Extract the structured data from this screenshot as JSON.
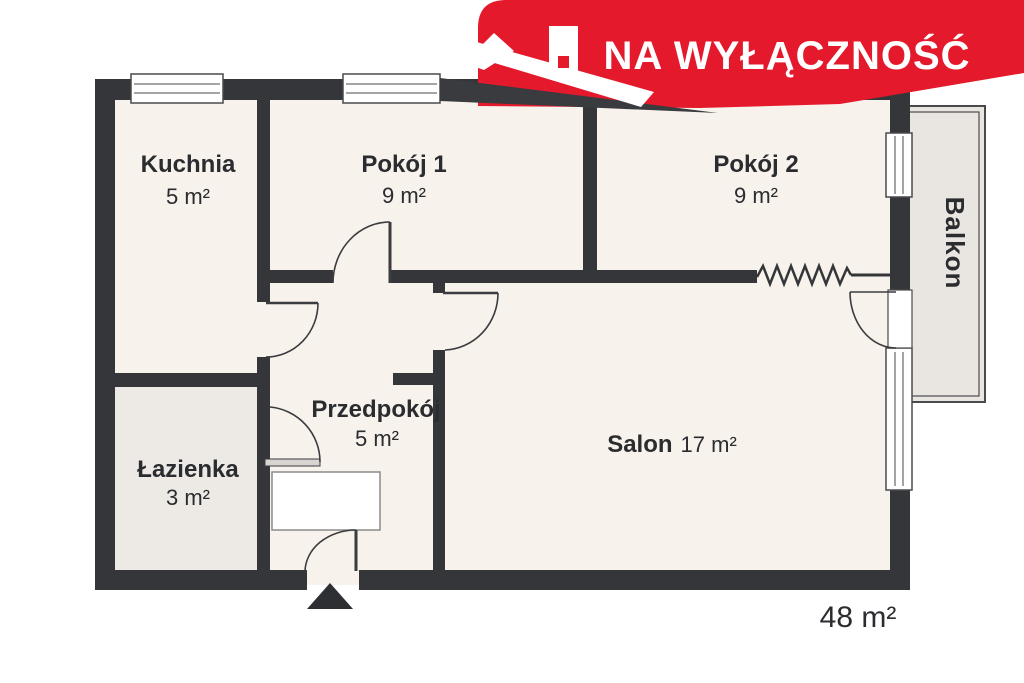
{
  "banner": {
    "label": "NA WYŁĄCZNOŚĆ",
    "color": "#e4192b",
    "icon": "house-roof-with-chimney"
  },
  "rooms": {
    "kuchnia": {
      "name": "Kuchnia",
      "area": "5 m²"
    },
    "pokoj1": {
      "name": "Pokój 1",
      "area": "9 m²"
    },
    "pokoj2": {
      "name": "Pokój 2",
      "area": "9 m²"
    },
    "lazienka": {
      "name": "Łazienka",
      "area": "3 m²"
    },
    "przedpokoj": {
      "name": "Przedpokój",
      "area": "5 m²"
    },
    "salon": {
      "name": "Salon",
      "area": "17 m²"
    }
  },
  "balcony": {
    "name": "Balkon"
  },
  "total_area": "48 m²",
  "colors": {
    "wall": "#35363a",
    "room_fill": "#f7f2ec",
    "bath_fill": "#edeae5",
    "balcony_fill": "#e9e6e1",
    "banner_red": "#e4192b"
  }
}
